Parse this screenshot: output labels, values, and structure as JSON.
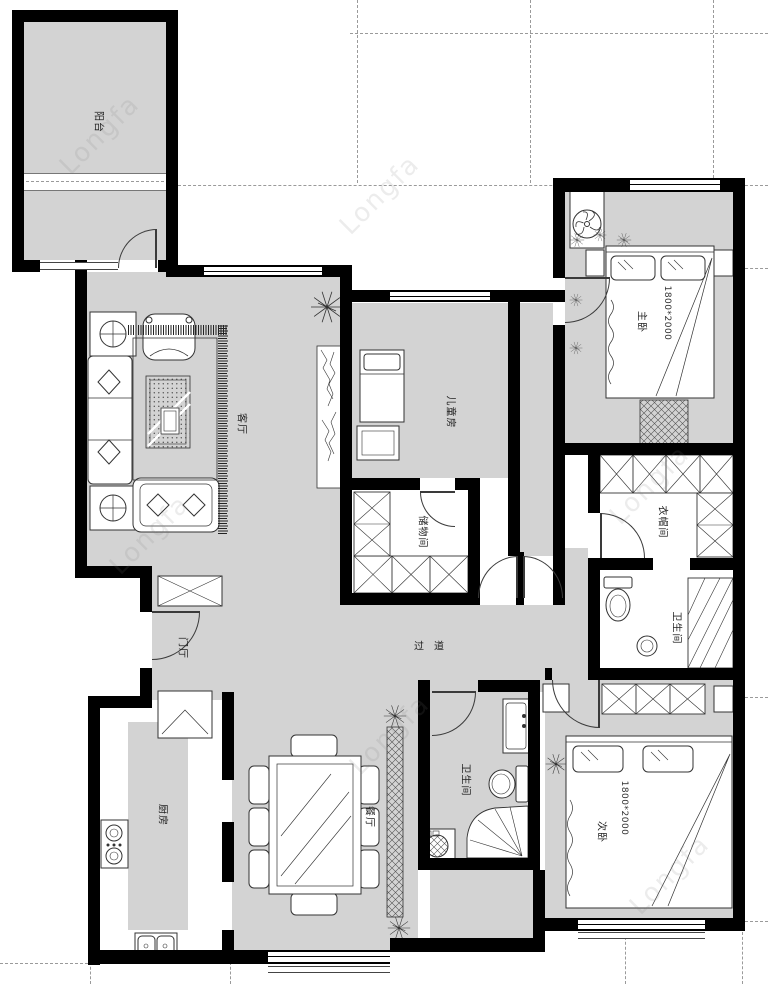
{
  "plan": {
    "watermark": "Longfa",
    "rooms": {
      "balcony": {
        "label": "阳台"
      },
      "living": {
        "label": "客厅"
      },
      "children": {
        "label": "儿童房"
      },
      "master": {
        "label": "主卧",
        "bed_size": "1800*2000"
      },
      "cloakroom": {
        "label": "衣帽间"
      },
      "master_bath": {
        "label": "卫生间"
      },
      "storage": {
        "label": "储物间"
      },
      "hallway": {
        "label": "过道"
      },
      "foyer": {
        "label": "门厅"
      },
      "kitchen": {
        "label": "厨房"
      },
      "dining": {
        "label": "餐厅"
      },
      "bathroom": {
        "label": "卫生间"
      },
      "second": {
        "label": "次卧",
        "bed_size": "1800*2000"
      }
    },
    "colors": {
      "wall": "#000000",
      "floor": "#d3d3d3",
      "outline": "#3a3a3a",
      "grid": "#9a9a9a"
    }
  }
}
